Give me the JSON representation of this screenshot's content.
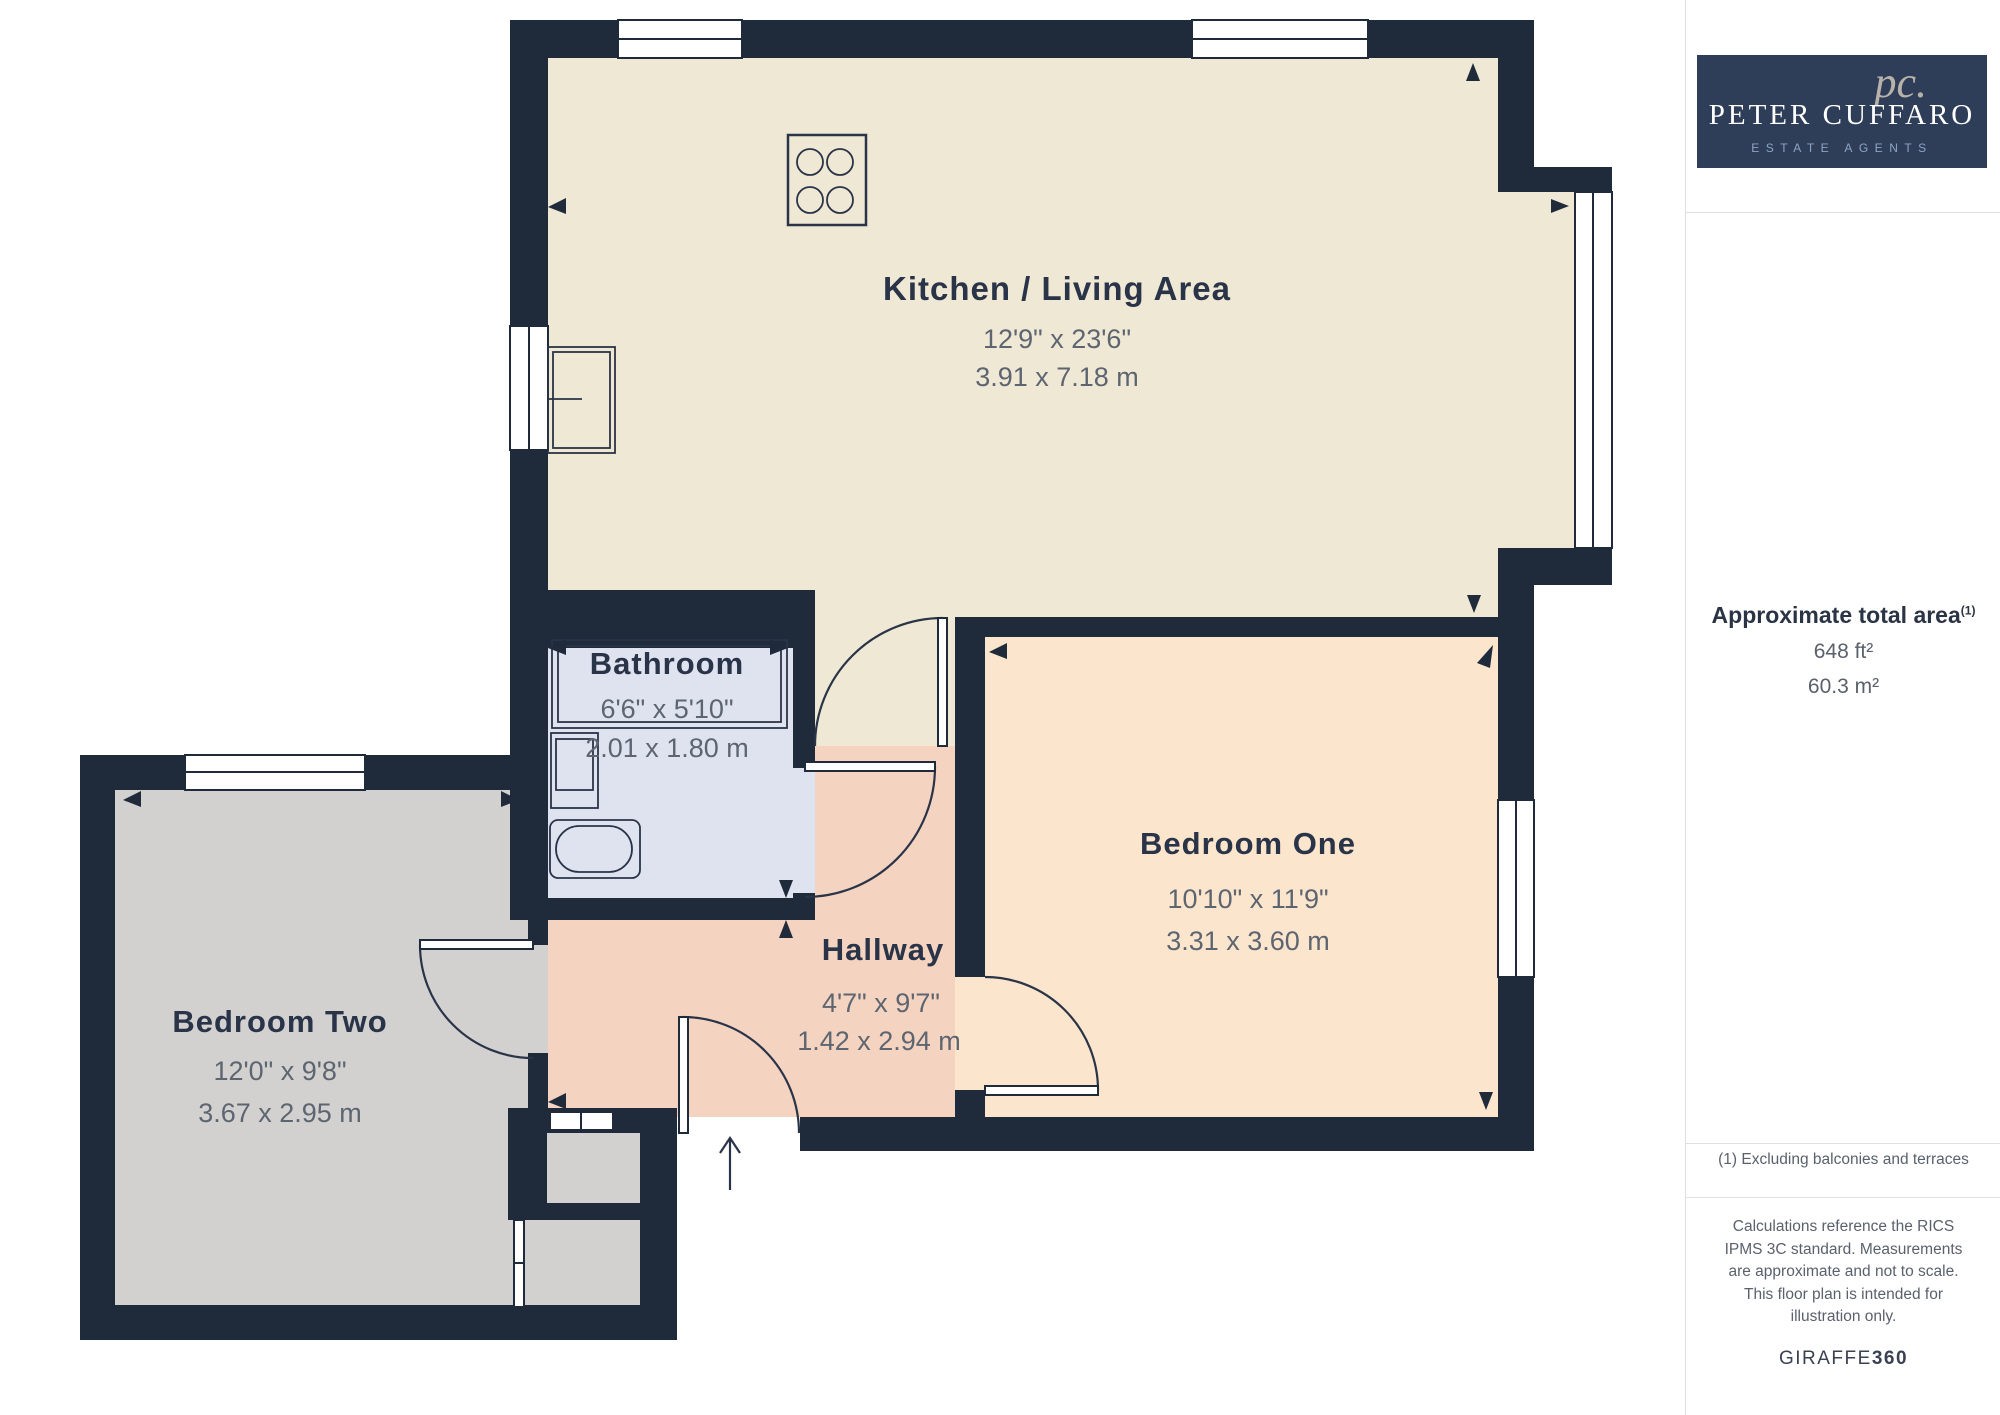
{
  "theme": {
    "wall_color": "#1f2b3a",
    "plan_text": "#2a3448",
    "plan_dim": "#5d6571",
    "sidebar_navy": "#2f3e58",
    "divider": "#e0e0e0"
  },
  "floorplan": {
    "rooms": {
      "kitchen": {
        "name": "Kitchen / Living Area",
        "size_imperial": "12'9\" x 23'6\"",
        "size_metric": "3.91 x 7.18 m",
        "fill": "#efe8d4"
      },
      "bathroom": {
        "name": "Bathroom",
        "size_imperial": "6'6\" x 5'10\"",
        "size_metric": "2.01 x 1.80 m",
        "fill": "#dfe3f0"
      },
      "bedroom_one": {
        "name": "Bedroom One",
        "size_imperial": "10'10\" x 11'9\"",
        "size_metric": "3.31 x 3.60 m",
        "fill": "#fce5cd"
      },
      "bedroom_two": {
        "name": "Bedroom Two",
        "size_imperial": "12'0\" x 9'8\"",
        "size_metric": "3.67 x 2.95 m",
        "fill": "#d2d1d0"
      },
      "hallway": {
        "name": "Hallway",
        "size_imperial": "4'7\" x 9'7\"",
        "size_metric": "1.42 x 2.94 m",
        "fill": "#f5d3c1"
      }
    }
  },
  "sidebar": {
    "logo": {
      "monogram": "pc.",
      "name": "PETER CUFFARO",
      "tagline": "ESTATE AGENTS"
    },
    "area": {
      "title": "Approximate total area",
      "reference": "(1)",
      "imperial": "648 ft²",
      "metric": "60.3 m²"
    },
    "footnote": "(1) Excluding balconies and terraces",
    "disclaimer": "Calculations reference the RICS IPMS 3C standard. Measurements are approximate and not to scale. This floor plan is intended for illustration only.",
    "brand": {
      "name": "GIRAFFE",
      "suffix": "360"
    }
  }
}
